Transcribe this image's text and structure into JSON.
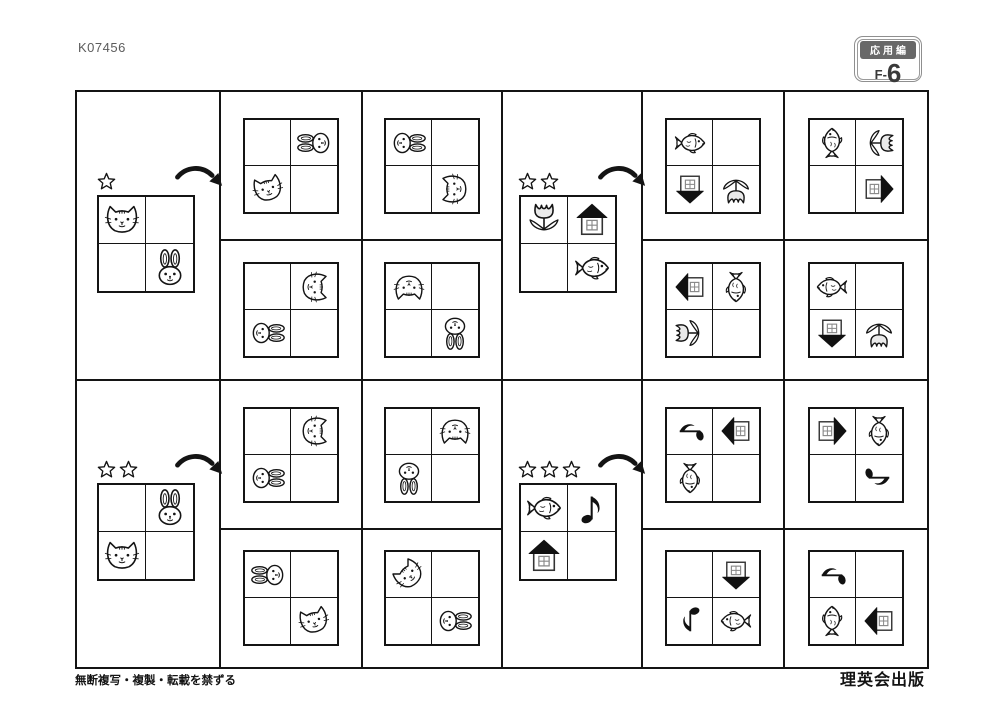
{
  "header": {
    "code": "K07456",
    "badge": {
      "category": "応用編",
      "level_prefix": "F-",
      "level_number": "6"
    }
  },
  "footer": {
    "left": "無断複写・複製・転載を禁ずる",
    "right": "理英会出版"
  },
  "colors": {
    "line": "#141414",
    "tulip_fill": "#eaeaea",
    "badge_header": "#686868",
    "badge_border": "#8f8f8f",
    "house_roof": "#111111",
    "window_frame": "#888888"
  },
  "icon_names": [
    "cat-icon",
    "rabbit-icon",
    "tulip-icon",
    "house-icon",
    "fish-icon",
    "note-icon",
    "star-icon",
    "rotate-clockwise-arrow-icon"
  ],
  "puzzles": [
    {
      "stars": 1,
      "rotation_arrow": "clockwise",
      "grid": [
        {
          "icon": "cat",
          "rot": 0
        },
        null,
        null,
        {
          "icon": "rabbit",
          "rot": 0
        }
      ],
      "options": [
        [
          null,
          {
            "icon": "rabbit",
            "rot": -90
          },
          {
            "icon": "cat",
            "rot": -15
          },
          null
        ],
        [
          {
            "icon": "rabbit",
            "rot": 90
          },
          null,
          null,
          {
            "icon": "cat",
            "rot": -90
          }
        ],
        [
          null,
          {
            "icon": "cat",
            "rot": 90
          },
          {
            "icon": "rabbit",
            "rot": 90
          },
          null
        ],
        [
          {
            "icon": "cat",
            "rot": 180
          },
          null,
          null,
          {
            "icon": "rabbit",
            "rot": 180
          }
        ]
      ]
    },
    {
      "stars": 2,
      "rotation_arrow": "clockwise",
      "grid": [
        {
          "icon": "tulip",
          "rot": 0
        },
        {
          "icon": "house",
          "rot": 0
        },
        null,
        {
          "icon": "fish",
          "rot": 0
        }
      ],
      "options": [
        [
          {
            "icon": "fish",
            "rot": 0
          },
          null,
          {
            "icon": "house",
            "rot": 180
          },
          {
            "icon": "tulip",
            "rot": 180
          }
        ],
        [
          {
            "icon": "fish",
            "rot": -90
          },
          {
            "icon": "tulip",
            "rot": 90
          },
          null,
          {
            "icon": "house",
            "rot": 90
          }
        ],
        [
          {
            "icon": "house",
            "rot": -90
          },
          {
            "icon": "fish",
            "rot": 90
          },
          {
            "icon": "tulip",
            "rot": -90
          },
          null
        ],
        [
          {
            "icon": "fish",
            "rot": 0,
            "flip": true
          },
          null,
          {
            "icon": "house",
            "rot": 180
          },
          {
            "icon": "tulip",
            "rot": 180
          }
        ]
      ]
    },
    {
      "stars": 2,
      "rotation_arrow": "clockwise",
      "grid": [
        null,
        {
          "icon": "rabbit",
          "rot": 0
        },
        {
          "icon": "cat",
          "rot": 0
        },
        null
      ],
      "options": [
        [
          null,
          {
            "icon": "cat",
            "rot": 90
          },
          {
            "icon": "rabbit",
            "rot": 90
          },
          null
        ],
        [
          null,
          {
            "icon": "cat",
            "rot": 180
          },
          {
            "icon": "rabbit",
            "rot": 180
          },
          null
        ],
        [
          {
            "icon": "rabbit",
            "rot": -90
          },
          null,
          null,
          {
            "icon": "cat",
            "rot": -15
          }
        ],
        [
          {
            "icon": "cat",
            "rot": -45
          },
          null,
          null,
          {
            "icon": "rabbit",
            "rot": 90
          }
        ]
      ]
    },
    {
      "stars": 3,
      "rotation_arrow": "clockwise",
      "grid": [
        {
          "icon": "fish",
          "rot": 0
        },
        {
          "icon": "note",
          "rot": 0
        },
        {
          "icon": "house",
          "rot": 0
        },
        null
      ],
      "options": [
        [
          {
            "icon": "note",
            "rot": -90
          },
          {
            "icon": "house",
            "rot": -90
          },
          {
            "icon": "fish",
            "rot": 90
          },
          null
        ],
        [
          {
            "icon": "house",
            "rot": 90
          },
          {
            "icon": "fish",
            "rot": 90
          },
          null,
          {
            "icon": "note",
            "rot": 90
          }
        ],
        [
          null,
          {
            "icon": "house",
            "rot": 180
          },
          {
            "icon": "note",
            "rot": 180
          },
          {
            "icon": "fish",
            "rot": 0,
            "flip": true
          }
        ],
        [
          {
            "icon": "note",
            "rot": -90
          },
          null,
          {
            "icon": "fish",
            "rot": -90
          },
          {
            "icon": "house",
            "rot": -90
          }
        ]
      ]
    }
  ]
}
